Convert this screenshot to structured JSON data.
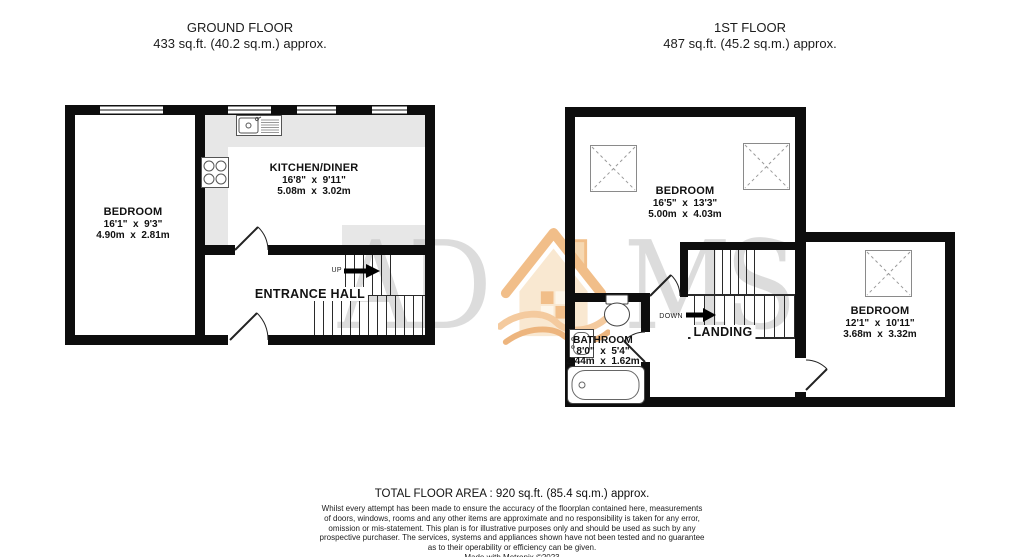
{
  "header": {
    "ground_floor": {
      "title": "GROUND FLOOR",
      "area": "433 sq.ft. (40.2 sq.m.) approx."
    },
    "first_floor": {
      "title": "1ST FLOOR",
      "area": "487 sq.ft. (45.2 sq.m.) approx."
    }
  },
  "ground_floor": {
    "bedroom": {
      "name": "BEDROOM",
      "imperial": "16'1\"  x  9'3\"",
      "metric": "4.90m  x  2.81m"
    },
    "kitchen": {
      "name": "KITCHEN/DINER",
      "imperial": "16'8\"  x  9'11\"",
      "metric": "5.08m  x  3.02m"
    },
    "hall": {
      "name": "ENTRANCE HALL"
    },
    "stairs_direction": "UP"
  },
  "first_floor": {
    "bedroom1": {
      "name": "BEDROOM",
      "imperial": "16'5\"  x  13'3\"",
      "metric": "5.00m  x  4.03m"
    },
    "bedroom2": {
      "name": "BEDROOM",
      "imperial": "12'1\"  x  10'11\"",
      "metric": "3.68m  x  3.32m"
    },
    "bathroom": {
      "name": "BATHROOM",
      "imperial": "8'0\"  x  5'4\"",
      "metric": "2.44m  x  1.62m"
    },
    "landing": {
      "name": "LANDING"
    },
    "stairs_direction": "DOWN"
  },
  "watermark": {
    "left_letters": "AD",
    "right_letters": "MS"
  },
  "footer": {
    "total": "TOTAL FLOOR AREA : 920 sq.ft. (85.4 sq.m.) approx.",
    "disclaimer_lines": [
      "Whilst every attempt has been made to ensure the accuracy of the floorplan contained here, measurements",
      "of doors, windows, rooms and any other items are approximate and no responsibility is taken for any error,",
      "omission or mis-statement. This plan is for illustrative purposes only and should be used as such by any",
      "prospective purchaser. The services, systems and appliances shown have not been tested and no guarantee",
      "as to their operability or efficiency can be given.",
      "Made with Metropix ©2023"
    ]
  },
  "colors": {
    "wall": "#0d0d0d",
    "counter": "#e7e7e7",
    "watermark_text": "#c0c0c0",
    "watermark_orange": "#eeae6c"
  }
}
